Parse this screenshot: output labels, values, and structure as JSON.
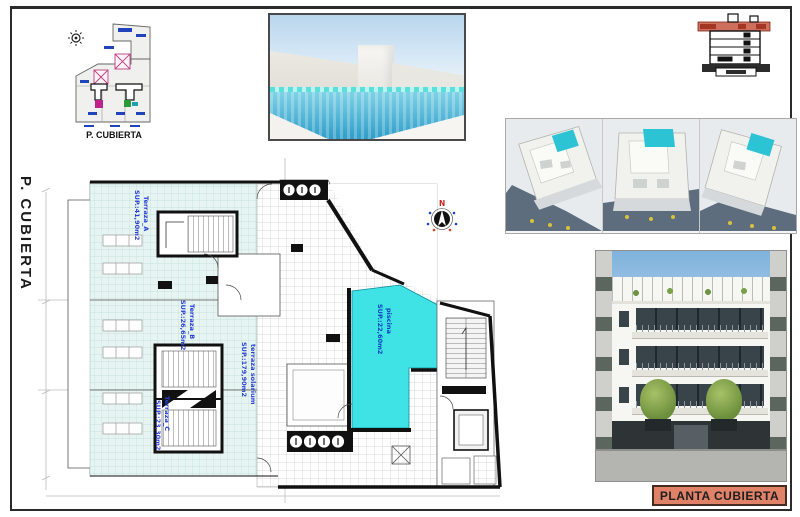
{
  "page": {
    "margin_label": "P. CUBIERTA",
    "title_block_label": "PLANTA CUBIERTA"
  },
  "key_plan": {
    "caption": "P. CUBIERTA"
  },
  "plan": {
    "compass_north_label": "N",
    "rooms": {
      "terraza_a": {
        "name": "Terraza_A",
        "area": "SUP.:41,90m2"
      },
      "terraza_b": {
        "name": "Terraza_B",
        "area": "SUP.:26,65m2"
      },
      "terraza_c": {
        "name": "Terraza_C",
        "area": "SUP.:23,30m2"
      },
      "solarium": {
        "name": "terraza solarium",
        "area": "SUP.:179,90m2"
      },
      "piscina": {
        "name": "piscina",
        "area": "SUP.:22,60m2"
      }
    }
  },
  "colors": {
    "pool_water": "#3fe3e6",
    "terrace_tile": "#e7f5f2",
    "label_blue": "#2a3fd4",
    "title_background": "#e08268",
    "section_highlight": "#cd6f5c",
    "wall_black": "#111111"
  }
}
